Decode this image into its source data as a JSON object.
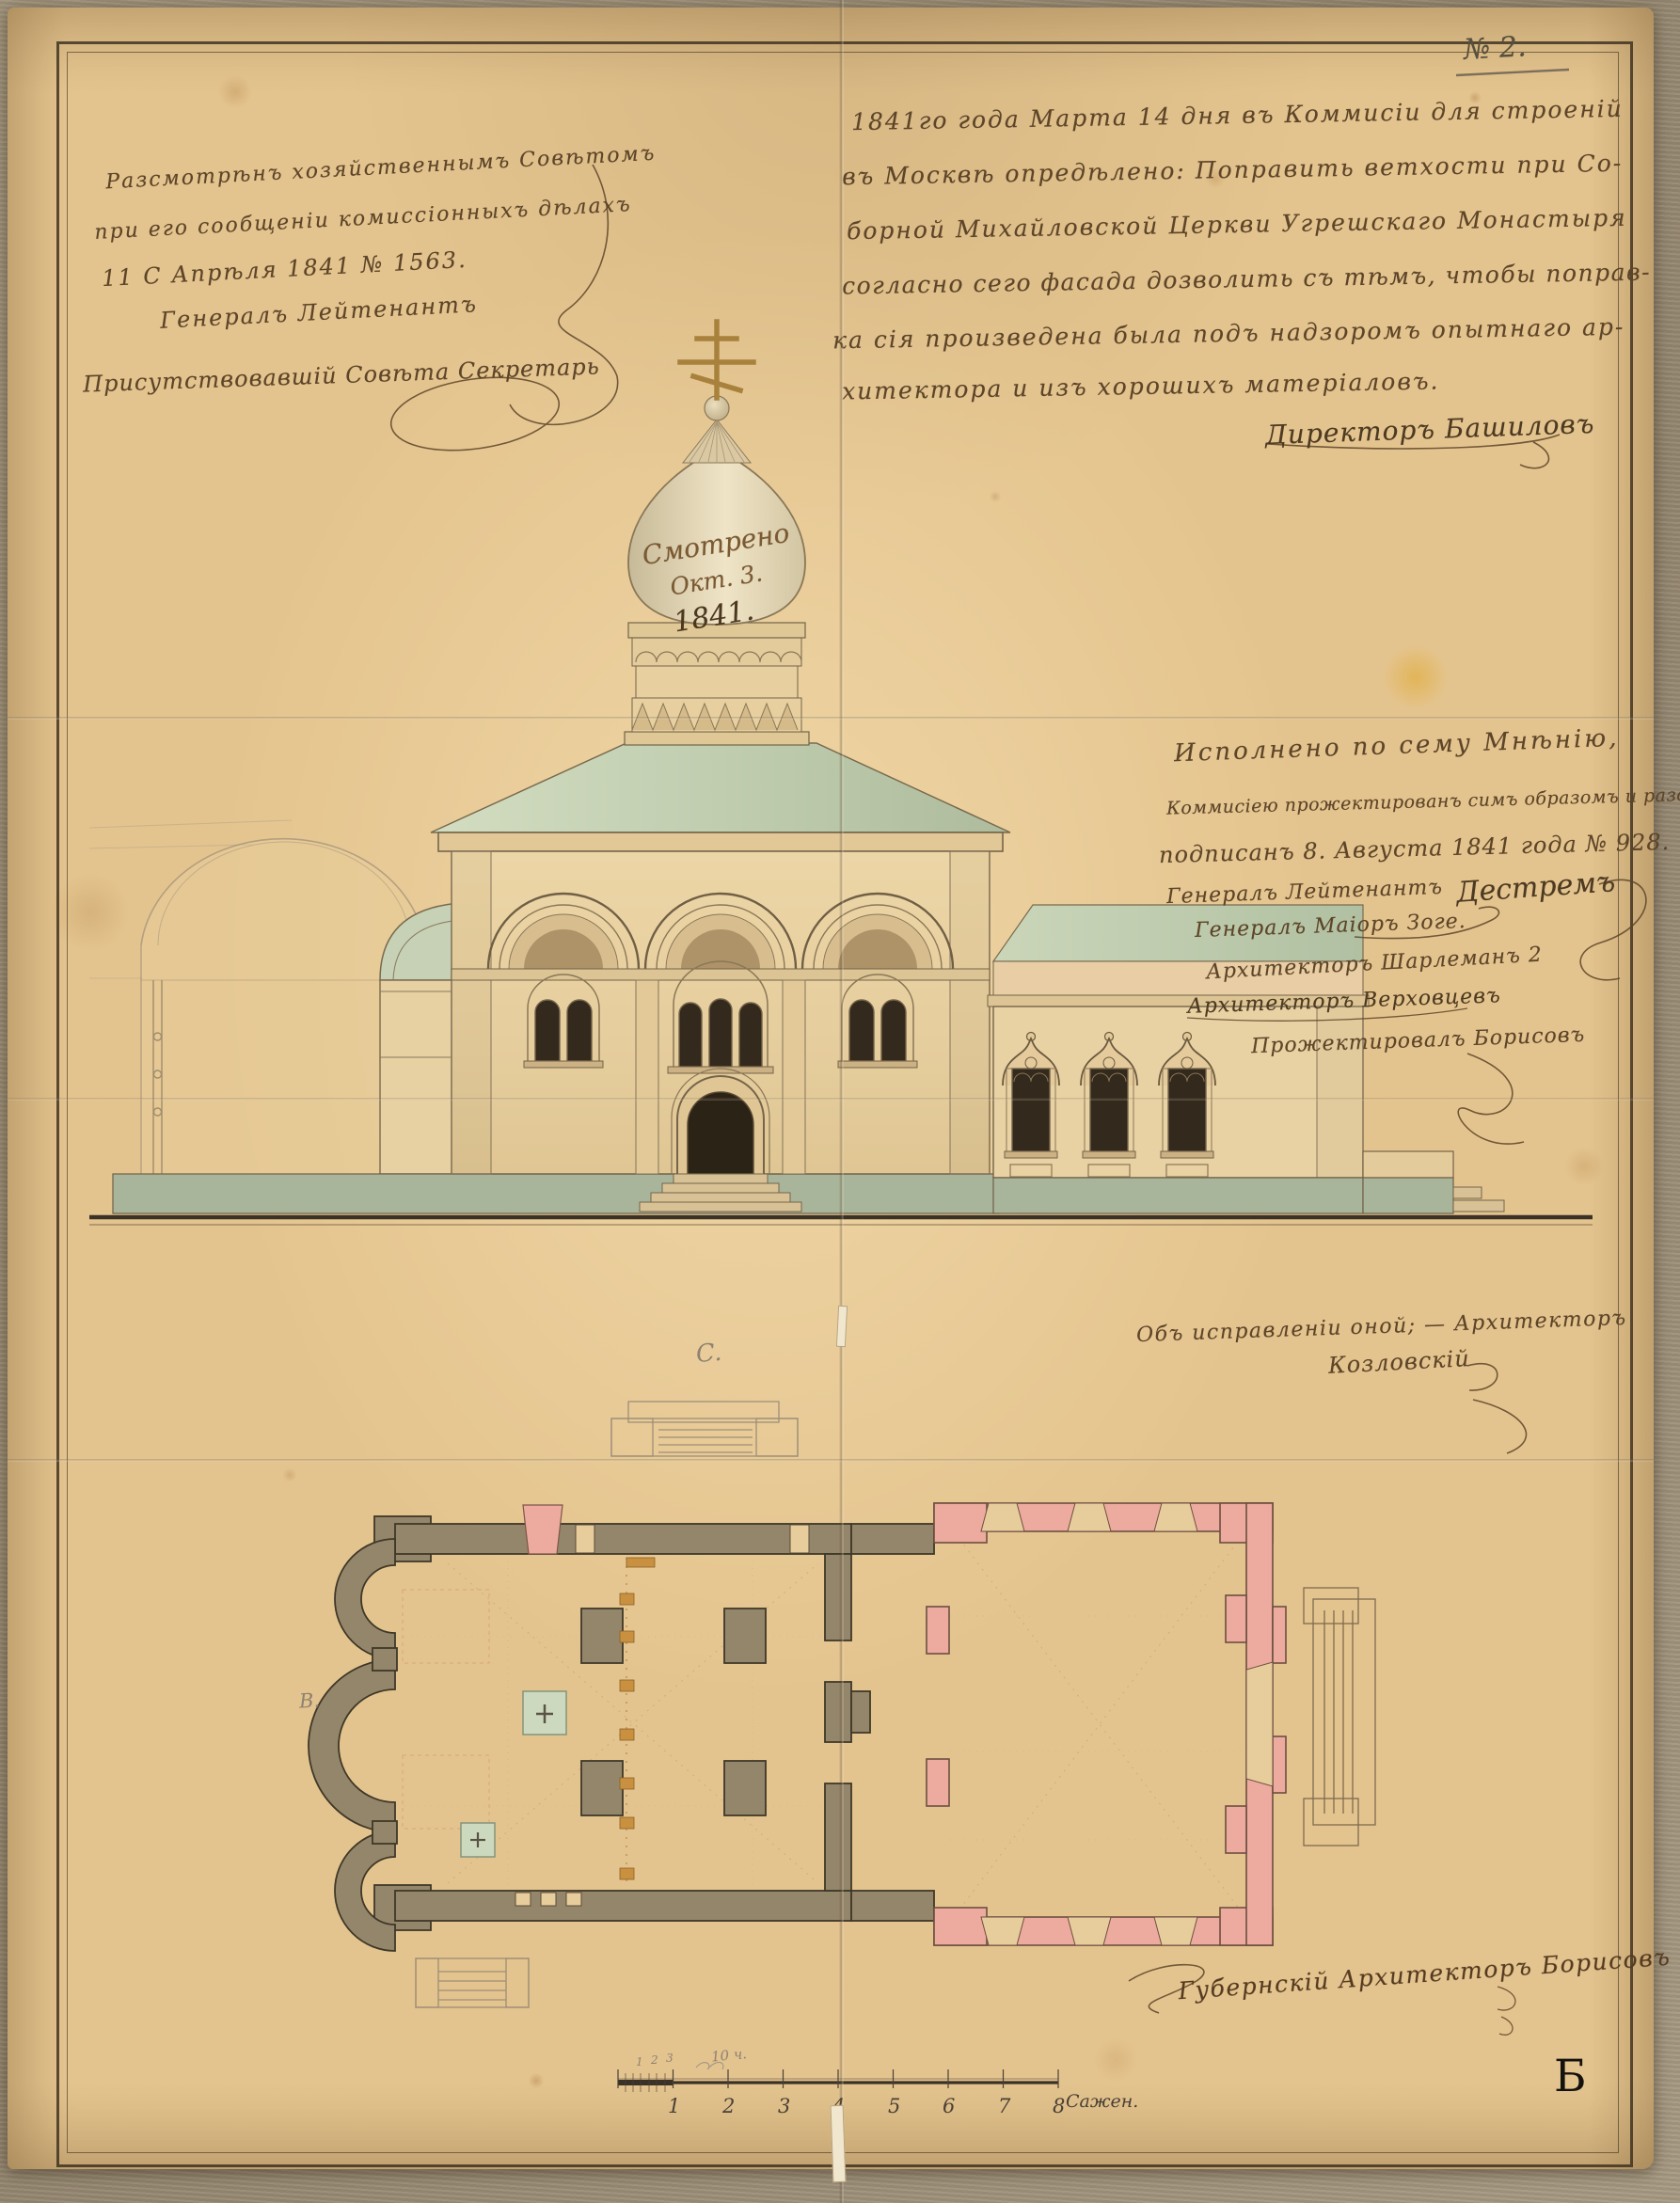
{
  "colors": {
    "paper": "#e4c48e",
    "ink": "#5d4529",
    "pencil": "#8d8171",
    "wall_olive": "#94866a",
    "wall_pink": "#ecab9e",
    "roof_green": "#c3cfb2",
    "plinth_green": "#a9b59b",
    "cross_gold": "#a8823c",
    "window_dark": "#33291c"
  },
  "labels": {
    "archive_number": "№ 2.",
    "corner_letter": "Б",
    "pencil_plan_top": "C.",
    "pencil_plan_left": "В.",
    "pencil_scale_note": "10 ч."
  },
  "notes": {
    "review": {
      "line1": "Разсмотрѣнъ хозяйственнымъ Совѣтомъ",
      "line2": "при его сообщеніи комиссіонныхъ дѣлахъ",
      "line3": "11 С Апрѣля 1841 № 1563.",
      "line4": "Генералъ Лейтенантъ",
      "line5": "Присутствовавшій Совѣта Секретарь"
    },
    "resolution": {
      "line1": "1841го года Марта 14 дня въ Коммисіи для строеній",
      "line2": "въ Москвѣ опредѣлено: Поправить ветхости при Со-",
      "line3": "борной Михайловской Церкви Угрешскаго Монастыря",
      "line4": "согласно сего фасада дозволить съ тѣмъ, чтобы поправ-",
      "line5": "ка сія произведена была подъ надзоромъ опытнаго ар-",
      "line6": "хитектора и изъ хорошихъ матеріаловъ.",
      "signature": "Директоръ Башиловъ"
    },
    "dome": {
      "line1": "Смотрено",
      "line2": "Окт. 3.",
      "line3": "1841."
    },
    "approval": {
      "line1": "Исполнено по сему Мнѣнію,",
      "line2": "Коммисіею прожектированъ симъ образомъ и разсмотрѣнъ",
      "line3": "подписанъ 8. Августа 1841 года № 928.",
      "line4": "Генералъ Лейтенантъ",
      "line4_signature": "Дестремъ",
      "line5": "Генералъ Маіоръ Зоге.",
      "line6": "Архитекторъ Шарлеманъ 2",
      "line7": "Архитекторъ Верховцевъ",
      "line8": "Прожектировалъ Борисовъ"
    },
    "facade": {
      "line1": "Объ исправленіи оной; — Архитекторъ",
      "line2": "Козловскій"
    },
    "plan_signature": "Губернскій Архитекторъ Борисовъ"
  },
  "scale_bar": {
    "numbers": [
      "1",
      "2",
      "3",
      "4",
      "5",
      "6",
      "7",
      "8"
    ],
    "subdivisions": [
      "1",
      "2",
      "3"
    ],
    "unit_label": "Сажен."
  }
}
